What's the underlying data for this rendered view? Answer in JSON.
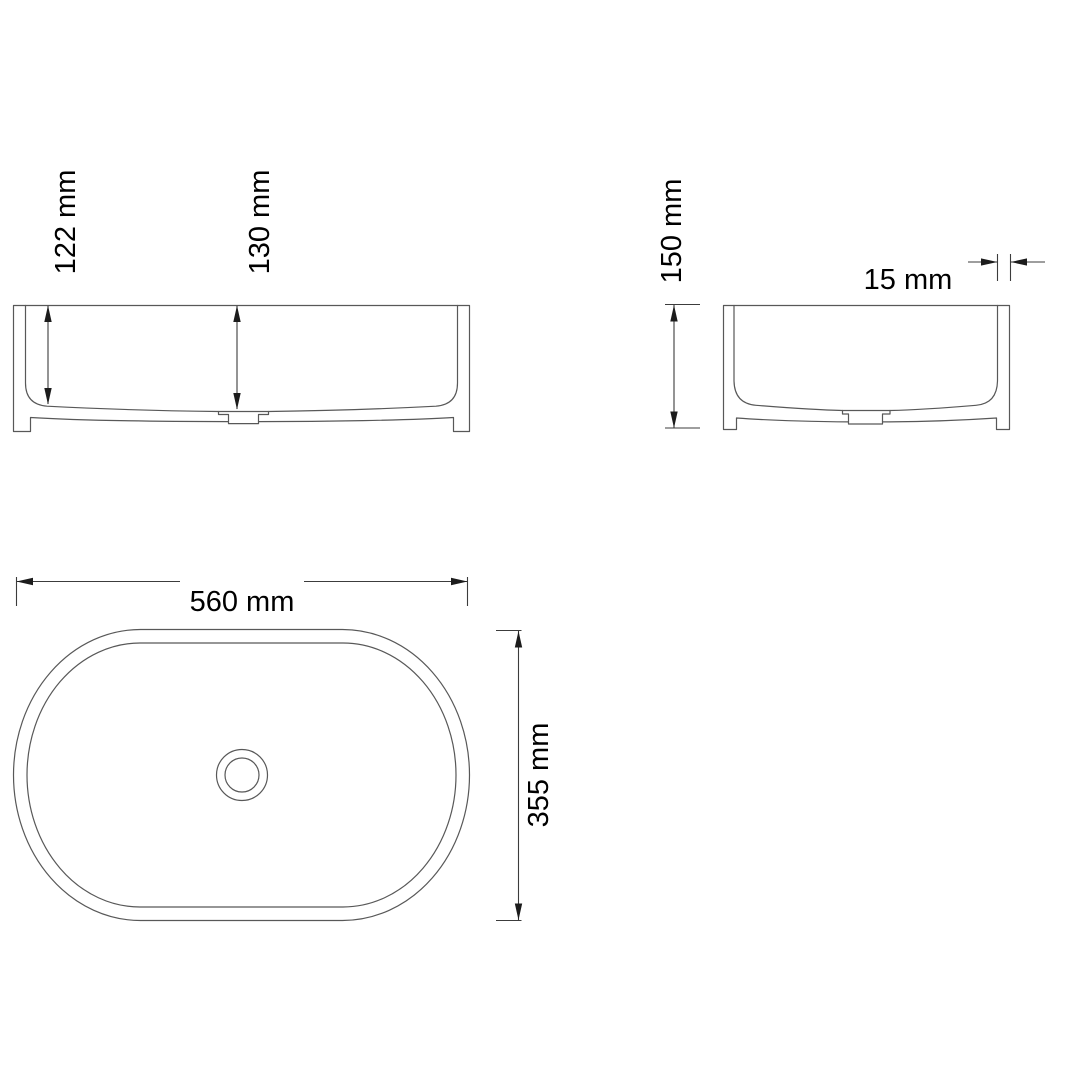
{
  "page": {
    "kind": "technical-drawing",
    "subject": "oval countertop basin, three orthographic views"
  },
  "colors": {
    "background": "#ffffff",
    "outline": "#585858",
    "dimension_line": "#3c3c3c",
    "text": "#000000"
  },
  "views": {
    "front_elevation": {
      "dim_labels": {
        "inner_depth": "122 mm",
        "drain_depth": "130 mm"
      }
    },
    "side_elevation": {
      "dim_labels": {
        "overall_height": "150 mm",
        "wall_thickness": "15 mm"
      }
    },
    "plan_view": {
      "dim_labels": {
        "overall_width": "560 mm",
        "overall_depth": "355 mm"
      }
    }
  }
}
